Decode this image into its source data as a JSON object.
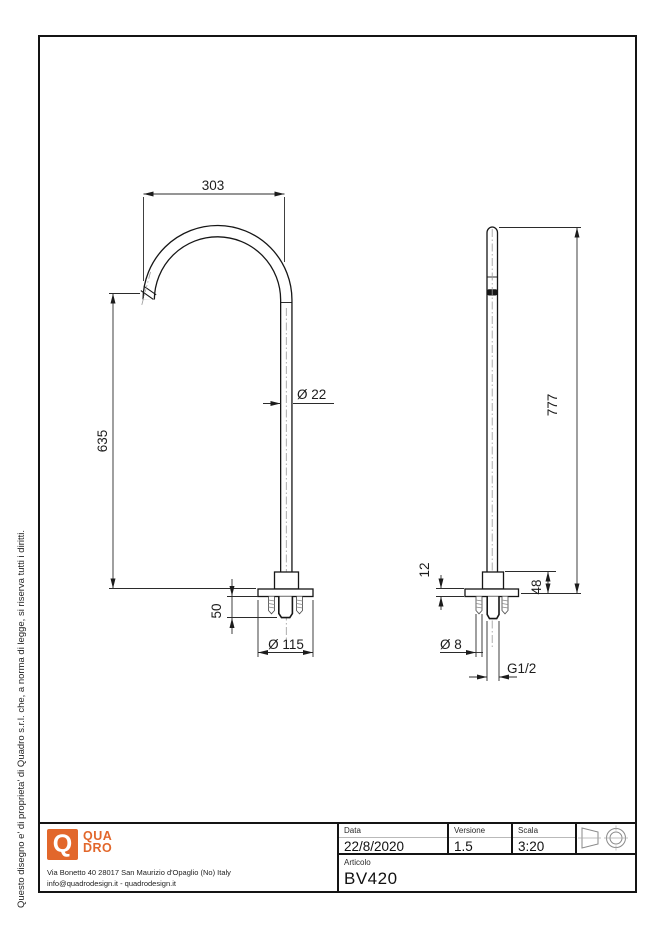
{
  "side_note": "Questo disegno e' di proprieta' di Quadro s.r.l. che, a norma di legge, si riserva tutti i diritti.",
  "drawing": {
    "front_view": {
      "spout_reach": "303",
      "spout_height": "635",
      "tube_diameter": "Ø 22",
      "under_counter_length": "50",
      "base_diameter": "Ø 115"
    },
    "side_view": {
      "overall_height": "777",
      "flange_thickness": "12",
      "base_height": "48",
      "stud_diameter": "Ø 8",
      "inlet_thread": "G1/2"
    }
  },
  "title_block": {
    "data_label": "Data",
    "data_value": "22/8/2020",
    "versione_label": "Versione",
    "versione_value": "1.5",
    "scala_label": "Scala",
    "scala_value": "3:20",
    "articolo_label": "Articolo",
    "articolo_value": "BV420"
  },
  "company": {
    "logo_letter": "Q",
    "logo_line1": "QUA",
    "logo_line2": "DRO",
    "address": "Via Bonetto 40  28017 San Maurizio d'Opaglio (No) Italy",
    "contacts": "info@quadrodesign.it  -  quadrodesign.it"
  },
  "colors": {
    "brand": "#E2672B",
    "line": "#161616"
  }
}
